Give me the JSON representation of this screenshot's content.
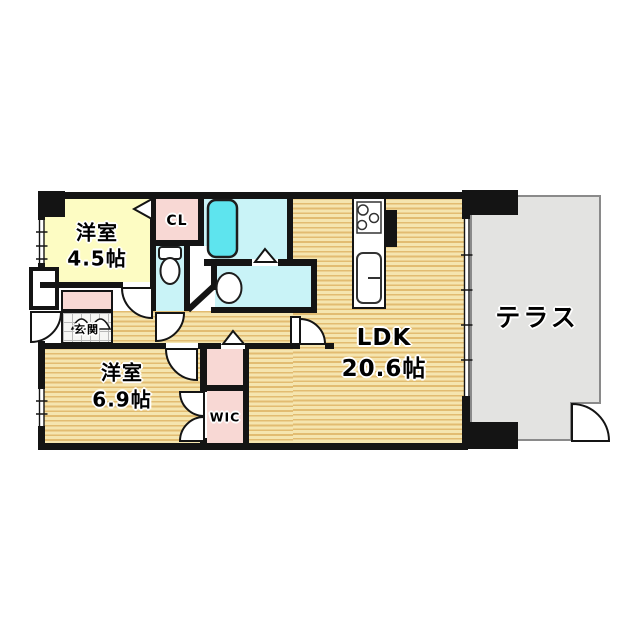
{
  "rooms": {
    "western_room_4_5": {
      "name": "洋室",
      "size": "4.5帖"
    },
    "closet_cl": {
      "name": "CL"
    },
    "entrance": {
      "name": "玄関"
    },
    "western_room_6_9": {
      "name": "洋室",
      "size": "6.9帖"
    },
    "wic": {
      "name": "WIC"
    },
    "ldk": {
      "name": "LDK",
      "size": "20.6帖"
    },
    "terrace": {
      "name": "テラス"
    }
  },
  "colors": {
    "wall": "#141414",
    "room_yellow": "#fdfcc3",
    "room_pink": "#f8d8d4",
    "room_cyan": "#c9f3f7",
    "bathtub_fill": "#5ee4ee",
    "terrace_gray": "#e3e3e1",
    "wood_dark": "#e2bc71",
    "wood_light": "#f5e5af"
  },
  "fixtures": {
    "bathtub": "bathtub",
    "toilet": "toilet",
    "washbasin": "wash-basin",
    "kitchen": "kitchen-counter-with-stove-and-sink"
  }
}
